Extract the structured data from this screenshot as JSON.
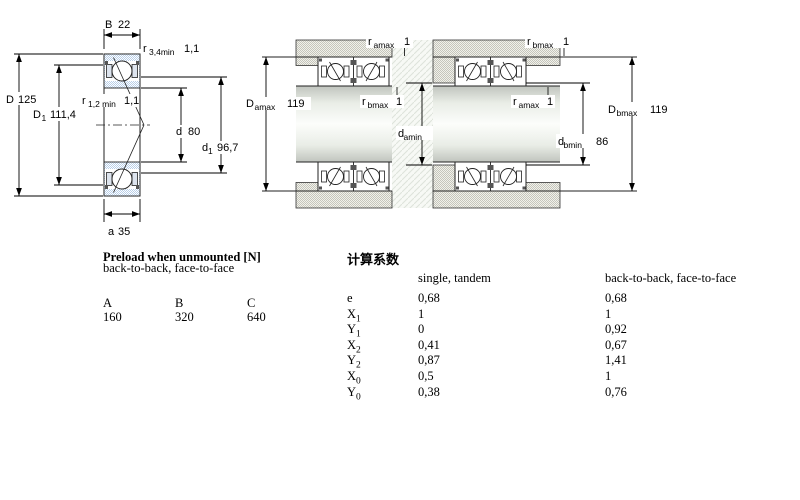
{
  "diagram": {
    "single": {
      "B": {
        "sym": "B",
        "value": "22"
      },
      "r34": {
        "sym": "r",
        "sub": "3,4min",
        "value": "1,1"
      },
      "D": {
        "sym": "D",
        "value": "125"
      },
      "D1": {
        "sym": "D",
        "sub": "1",
        "value": "111,4"
      },
      "r12": {
        "sym": "r",
        "sub": "1,2 min",
        "value": "1,1"
      },
      "d": {
        "sym": "d",
        "value": "80"
      },
      "d1": {
        "sym": "d",
        "sub": "1",
        "value": "96,7"
      },
      "a": {
        "sym": "a",
        "value": "35"
      }
    },
    "mounted_a": {
      "r_top": {
        "sym": "r",
        "sub": "amax",
        "value": "1"
      },
      "D": {
        "sym": "D",
        "sub": "amax",
        "value": "119"
      },
      "r_mid": {
        "sym": "r",
        "sub": "bmax",
        "value": "1"
      },
      "d": {
        "sym": "d",
        "sub": "amin",
        "value": "86"
      }
    },
    "mounted_b": {
      "r_top": {
        "sym": "r",
        "sub": "bmax",
        "value": "1"
      },
      "r_mid": {
        "sym": "r",
        "sub": "amax",
        "value": "1"
      },
      "d": {
        "sym": "d",
        "sub": "bmin",
        "value": "86"
      },
      "D": {
        "sym": "D",
        "sub": "bmax",
        "value": "119"
      }
    }
  },
  "preload": {
    "title": "Preload when unmounted [N]",
    "subtitle": "back-to-back, face-to-face",
    "columns": [
      "A",
      "B",
      "C"
    ],
    "values": [
      "160",
      "320",
      "640"
    ]
  },
  "factors": {
    "title": "计算系数",
    "col1": "single, tandem",
    "col2": "back-to-back, face-to-face",
    "rows": [
      {
        "label": "e",
        "sub": "",
        "v1": "0,68",
        "v2": "0,68"
      },
      {
        "label": "X",
        "sub": "1",
        "v1": "1",
        "v2": "1"
      },
      {
        "label": "Y",
        "sub": "1",
        "v1": "0",
        "v2": "0,92"
      },
      {
        "label": "X",
        "sub": "2",
        "v1": "0,41",
        "v2": "0,67"
      },
      {
        "label": "Y",
        "sub": "2",
        "v1": "0,87",
        "v2": "1,41"
      },
      {
        "label": "X",
        "sub": "0",
        "v1": "0,5",
        "v2": "1"
      },
      {
        "label": "Y",
        "sub": "0",
        "v1": "0,38",
        "v2": "0,76"
      }
    ]
  },
  "colors": {
    "bearing_blue": "#b8cfe9",
    "steel_gray": "#c9c9c0",
    "line": "#1a1a1a"
  }
}
